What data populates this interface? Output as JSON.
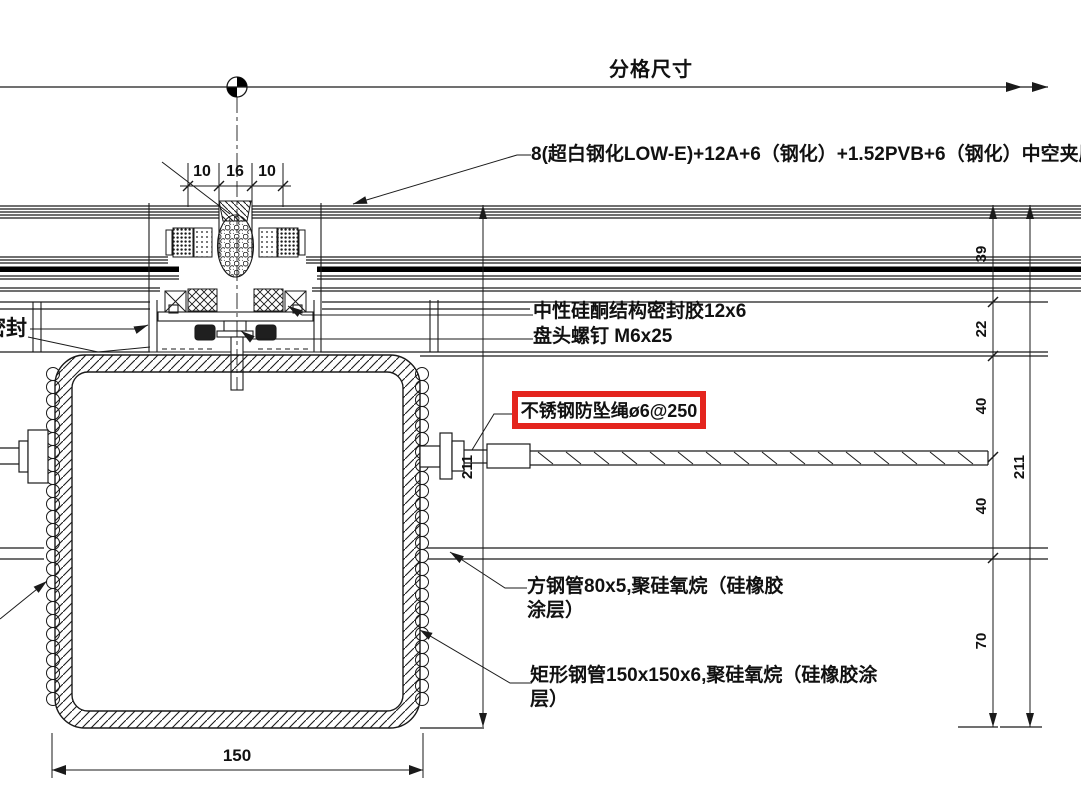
{
  "labels": {
    "grid_dim": "分格尺寸",
    "glass": "8(超白钢化LOW-E)+12A+6（钢化）+1.52PVB+6（钢化）中空夹层玻璃",
    "sealant": "中性硅酮结构密封胶12x6",
    "screw": "盘头螺钉 M6x25",
    "rope": "不锈钢防坠绳ø6@250",
    "square_tube_line1": "方钢管80x5,聚硅氧烷（硅橡胶",
    "square_tube_line2": "涂层）",
    "rect_tube_line1": "矩形钢管150x150x6,聚硅氧烷（硅橡胶涂",
    "rect_tube_line2": "层）",
    "left_partial": "密封"
  },
  "dimensions": {
    "top": [
      "10",
      "16",
      "10"
    ],
    "bottom_width": "150",
    "right_chain": [
      "39",
      "22",
      "40",
      "40",
      "70"
    ],
    "overall_right": "211",
    "overall_left": "211"
  },
  "colors": {
    "highlight_red": "#e4251e",
    "line": "#1a1a1a",
    "background": "#ffffff"
  }
}
